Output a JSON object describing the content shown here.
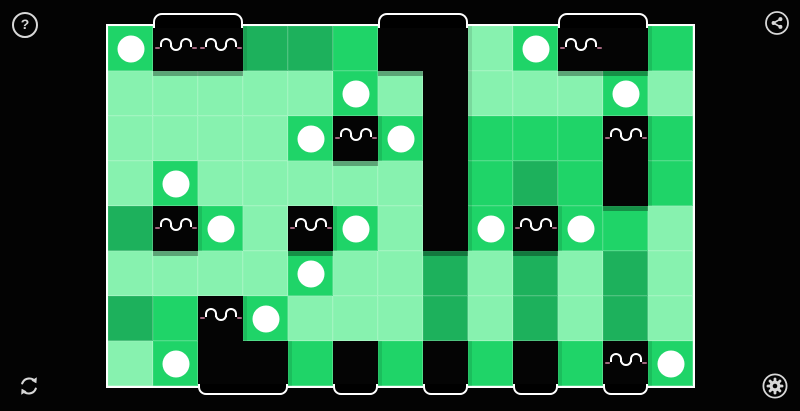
{
  "app": {
    "background": "#030303",
    "icon_color": "#D8D8D8"
  },
  "toolbar": {
    "help": {
      "icon": "question-mark-icon",
      "glyph": "?"
    },
    "share": {
      "icon": "share-icon"
    },
    "restart": {
      "icon": "restart-icon"
    },
    "settings": {
      "icon": "gear-icon"
    }
  },
  "board": {
    "left": 108,
    "top": 26,
    "cols": 13,
    "rows": 8,
    "cell_size": 45,
    "colors": {
      "pale": "#87F2AF",
      "bright": "#1FD468",
      "dark": "#1DB15C",
      "block": "#040404",
      "dot": "#FFFFFF",
      "face": "#FFFFFF",
      "blush": "#C97F9E",
      "border": "#FFFFFF"
    },
    "legend": {
      "p": "pale-green-tile",
      "b": "bright-green-tile",
      "d": "dark-green-tile",
      "k": "black-block"
    },
    "cells": [
      "bkkddbkkpbkkb",
      "pppppbpkpppbp",
      "ppppbkbkbbbkb",
      "pbpppppkbdbkb",
      "dkbpkbpkbkbbp",
      "ppppbppdpdpdp",
      "dbkbpppdpdpdp",
      "pbkkbkbkbkbkb"
    ],
    "dots": [
      [
        1,
        1
      ],
      [
        1,
        10
      ],
      [
        2,
        6
      ],
      [
        2,
        12
      ],
      [
        3,
        5
      ],
      [
        3,
        7
      ],
      [
        4,
        2
      ],
      [
        5,
        3
      ],
      [
        5,
        6
      ],
      [
        5,
        9
      ],
      [
        5,
        11
      ],
      [
        6,
        5
      ],
      [
        7,
        4
      ],
      [
        8,
        2
      ],
      [
        8,
        13
      ]
    ],
    "faces": [
      [
        1,
        2
      ],
      [
        1,
        3
      ],
      [
        1,
        11
      ],
      [
        3,
        6
      ],
      [
        3,
        12
      ],
      [
        5,
        2
      ],
      [
        5,
        5
      ],
      [
        5,
        10
      ],
      [
        7,
        3
      ],
      [
        8,
        12
      ]
    ],
    "top_tabs": [
      [
        2,
        3
      ],
      [
        7,
        8
      ],
      [
        11,
        12
      ]
    ],
    "bottom_tabs": [
      [
        3,
        4
      ],
      [
        6,
        6
      ],
      [
        8,
        8
      ],
      [
        10,
        10
      ],
      [
        12,
        12
      ]
    ]
  }
}
